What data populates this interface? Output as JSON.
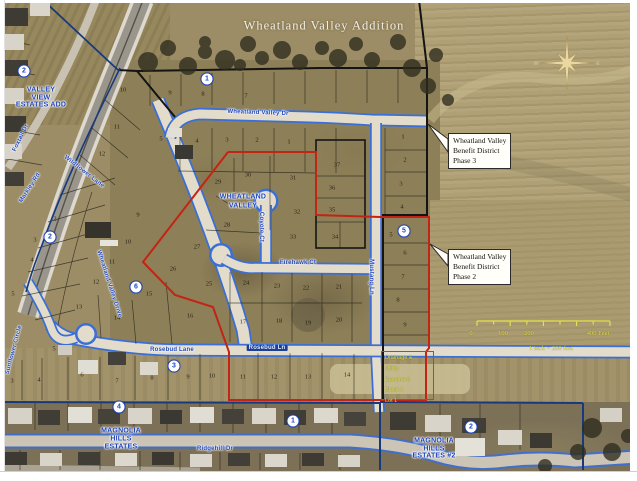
{
  "title": "Wheatland Valley Addition",
  "neighborhoods": [
    {
      "id": "valley-view",
      "x": 41,
      "y": 90,
      "lh": 7.5,
      "lines": [
        "VALLEY",
        "VIEW",
        "ESTATES ADD"
      ]
    },
    {
      "id": "wheatland-valley",
      "x": 243,
      "y": 197,
      "lh": 9,
      "lines": [
        "WHEATLAND",
        "VALLEY"
      ]
    },
    {
      "id": "magnolia-hills",
      "x": 121,
      "y": 431,
      "lh": 8,
      "lines": [
        "MAGNOLIA",
        "HILLS",
        "ESTATES"
      ]
    },
    {
      "id": "magnolia-hills-2",
      "x": 434,
      "y": 441,
      "lh": 7.5,
      "lines": [
        "MAGNOLIA",
        "HILLS",
        "ESTATES #2"
      ]
    }
  ],
  "callouts": [
    {
      "id": "phase3",
      "x": 448,
      "y": 133,
      "lines": [
        "Wheatland Valley",
        "Benefit District",
        "Phase 3"
      ]
    },
    {
      "id": "phase2",
      "x": 448,
      "y": 249,
      "lines": [
        "Wheatland Valley",
        "Benefit District",
        "Phase 2"
      ]
    }
  ],
  "streets": [
    {
      "name": "Wheatland Valley Dr",
      "x": 258,
      "y": 113,
      "rot": 2
    },
    {
      "name": "Wheatland Valley Drive",
      "x": 109,
      "y": 284,
      "rot": 72
    },
    {
      "name": "Wildflower Lane",
      "x": 84,
      "y": 172,
      "rot": 38
    },
    {
      "name": "Foxtail Dr",
      "x": 21,
      "y": 138,
      "rot": -64
    },
    {
      "name": "Markley Rd",
      "x": 30,
      "y": 188,
      "rot": -57
    },
    {
      "name": "Coyote Ct",
      "x": 261,
      "y": 227,
      "rot": 90
    },
    {
      "name": "Firehawk Ct",
      "x": 298,
      "y": 263,
      "rot": 0
    },
    {
      "name": "Mustang Ln",
      "x": 371,
      "y": 277,
      "rot": 90
    },
    {
      "name": "Rosebud Lane",
      "x": 172,
      "y": 350,
      "rot": 0
    },
    {
      "name": "Rosebud Ln",
      "x": 267,
      "y": 348,
      "rot": 0,
      "boxed": true
    },
    {
      "name": "Ridgehill Dr",
      "x": 215,
      "y": 449,
      "rot": 0
    },
    {
      "name": "Sunflower Circle",
      "x": 14,
      "y": 350,
      "rot": -75
    }
  ],
  "markers": [
    {
      "n": "2",
      "x": 24,
      "y": 71
    },
    {
      "n": "1",
      "x": 207,
      "y": 79
    },
    {
      "n": "2",
      "x": 50,
      "y": 237
    },
    {
      "n": "6",
      "x": 136,
      "y": 287
    },
    {
      "n": "5",
      "x": 404,
      "y": 231
    },
    {
      "n": "3",
      "x": 174,
      "y": 366
    },
    {
      "n": "4",
      "x": 119,
      "y": 407
    },
    {
      "n": "1",
      "x": 293,
      "y": 421
    },
    {
      "n": "2",
      "x": 471,
      "y": 427
    }
  ],
  "lots": [
    {
      "n": "10",
      "x": 123,
      "y": 90
    },
    {
      "n": "11",
      "x": 117,
      "y": 127
    },
    {
      "n": "12",
      "x": 102,
      "y": 154
    },
    {
      "n": "9",
      "x": 170,
      "y": 93
    },
    {
      "n": "8",
      "x": 203,
      "y": 94
    },
    {
      "n": "7",
      "x": 246,
      "y": 96
    },
    {
      "n": "5",
      "x": 161,
      "y": 139
    },
    {
      "n": "4",
      "x": 197,
      "y": 141
    },
    {
      "n": "3",
      "x": 227,
      "y": 140
    },
    {
      "n": "2",
      "x": 257,
      "y": 140
    },
    {
      "n": "1",
      "x": 289,
      "y": 142
    },
    {
      "n": "1",
      "x": 403,
      "y": 137
    },
    {
      "n": "2",
      "x": 405,
      "y": 160
    },
    {
      "n": "3",
      "x": 401,
      "y": 184
    },
    {
      "n": "4",
      "x": 402,
      "y": 207
    },
    {
      "n": "29",
      "x": 218,
      "y": 182
    },
    {
      "n": "30",
      "x": 248,
      "y": 175
    },
    {
      "n": "31",
      "x": 293,
      "y": 178
    },
    {
      "n": "37",
      "x": 337,
      "y": 165
    },
    {
      "n": "36",
      "x": 332,
      "y": 188
    },
    {
      "n": "35",
      "x": 332,
      "y": 210
    },
    {
      "n": "32",
      "x": 297,
      "y": 212
    },
    {
      "n": "28",
      "x": 227,
      "y": 225
    },
    {
      "n": "27",
      "x": 197,
      "y": 247
    },
    {
      "n": "33",
      "x": 293,
      "y": 237
    },
    {
      "n": "34",
      "x": 335,
      "y": 237
    },
    {
      "n": "26",
      "x": 173,
      "y": 269
    },
    {
      "n": "25",
      "x": 209,
      "y": 284
    },
    {
      "n": "24",
      "x": 246,
      "y": 283
    },
    {
      "n": "23",
      "x": 277,
      "y": 286
    },
    {
      "n": "22",
      "x": 306,
      "y": 288
    },
    {
      "n": "21",
      "x": 339,
      "y": 287
    },
    {
      "n": "15",
      "x": 149,
      "y": 294
    },
    {
      "n": "16",
      "x": 190,
      "y": 316
    },
    {
      "n": "17",
      "x": 243,
      "y": 322
    },
    {
      "n": "18",
      "x": 279,
      "y": 321
    },
    {
      "n": "19",
      "x": 308,
      "y": 323
    },
    {
      "n": "20",
      "x": 339,
      "y": 320
    },
    {
      "n": "9",
      "x": 138,
      "y": 215
    },
    {
      "n": "10",
      "x": 128,
      "y": 242
    },
    {
      "n": "11",
      "x": 112,
      "y": 262
    },
    {
      "n": "12",
      "x": 96,
      "y": 282
    },
    {
      "n": "13",
      "x": 79,
      "y": 307
    },
    {
      "n": "14",
      "x": 117,
      "y": 318
    },
    {
      "n": "2",
      "x": 55,
      "y": 219
    },
    {
      "n": "3",
      "x": 35,
      "y": 240
    },
    {
      "n": "4",
      "x": 32,
      "y": 260
    },
    {
      "n": "5",
      "x": 13,
      "y": 294
    },
    {
      "n": "5",
      "x": 391,
      "y": 235
    },
    {
      "n": "6",
      "x": 405,
      "y": 253
    },
    {
      "n": "7",
      "x": 403,
      "y": 277
    },
    {
      "n": "8",
      "x": 398,
      "y": 300
    },
    {
      "n": "9",
      "x": 405,
      "y": 325
    },
    {
      "n": "3",
      "x": 12,
      "y": 381
    },
    {
      "n": "4",
      "x": 39,
      "y": 380
    },
    {
      "n": "5",
      "x": 54,
      "y": 349
    },
    {
      "n": "6",
      "x": 82,
      "y": 375
    },
    {
      "n": "7",
      "x": 117,
      "y": 381
    },
    {
      "n": "8",
      "x": 152,
      "y": 378
    },
    {
      "n": "9",
      "x": 188,
      "y": 377
    },
    {
      "n": "10",
      "x": 212,
      "y": 376
    },
    {
      "n": "11",
      "x": 243,
      "y": 377
    },
    {
      "n": "12",
      "x": 274,
      "y": 377
    },
    {
      "n": "13",
      "x": 308,
      "y": 377
    },
    {
      "n": "14",
      "x": 347,
      "y": 375
    }
  ],
  "easement": {
    "lines": [
      "Drainage &",
      "Utility",
      "Easement",
      "Block 4",
      "Lot 1"
    ]
  },
  "scale_bar": {
    "tick_labels": [
      {
        "t": "0",
        "x": 471
      },
      {
        "t": "100",
        "x": 503
      },
      {
        "t": "200",
        "x": 529
      },
      {
        "t": "400 Feet",
        "x": 598
      }
    ],
    "caption": "1 inch = 200 feet"
  },
  "compass": {
    "letters": [
      {
        "t": "W",
        "x": 536,
        "y": 64
      },
      {
        "t": "E",
        "x": 598,
        "y": 64
      }
    ]
  },
  "colors": {
    "label_blue": "#1d43b8",
    "boundary_red": "#c32413",
    "boundary_navy": "#173a7d",
    "easement_green": "#2e8b2e",
    "scale_yellow": "#e4df4a"
  }
}
